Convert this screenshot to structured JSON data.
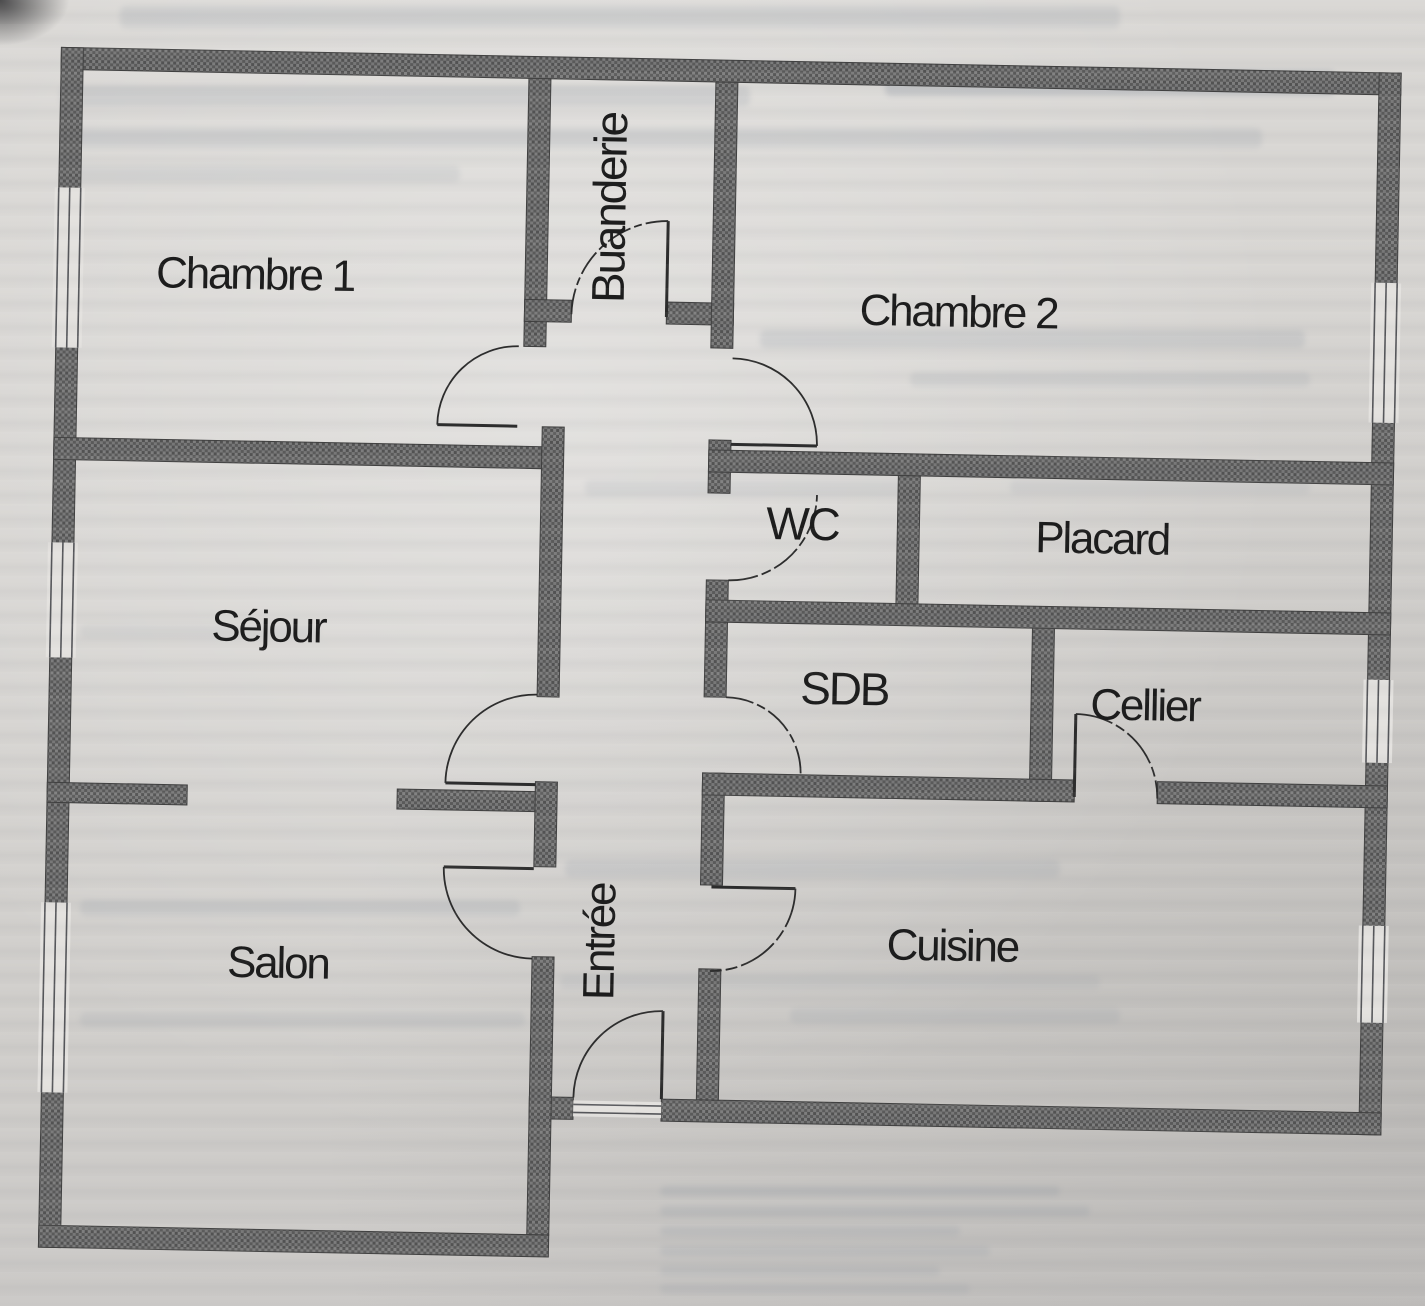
{
  "document": {
    "kind": "scanned apartment floor plan",
    "language": "French",
    "orientation": "plan occupies full page, slightly tilted scan with bleed-through text from reverse side"
  },
  "colors": {
    "paper": "#d6d4d1",
    "wall_fill": "#6d6d6d",
    "wall_speckle_dark": "#525252",
    "wall_speckle_light": "#7e7e7e",
    "wall_outline": "#3f3f3f",
    "thin_line": "#2b2b2b",
    "label_ink": "#1b1b1b",
    "bleed_text": "#8e97a2"
  },
  "rooms": {
    "chambre1": {
      "label": "Chambre 1",
      "text_orientation": "horizontal"
    },
    "buanderie": {
      "label": "Buanderie",
      "text_orientation": "vertical"
    },
    "chambre2": {
      "label": "Chambre 2",
      "text_orientation": "horizontal"
    },
    "wc": {
      "label": "WC",
      "text_orientation": "horizontal"
    },
    "placard": {
      "label": "Placard",
      "text_orientation": "horizontal"
    },
    "sejour": {
      "label": "Séjour",
      "text_orientation": "horizontal"
    },
    "sdb": {
      "label": "SDB",
      "text_orientation": "horizontal"
    },
    "cellier": {
      "label": "Cellier",
      "text_orientation": "horizontal"
    },
    "salon": {
      "label": "Salon",
      "text_orientation": "horizontal"
    },
    "entree": {
      "label": "Entrée",
      "text_orientation": "vertical"
    },
    "cuisine": {
      "label": "Cuisine",
      "text_orientation": "horizontal"
    }
  },
  "plan_features": {
    "window_count": 6,
    "door_swing_count": 10,
    "main_entrance_location": "bottom center of plan, between Salon and Cuisine",
    "windows": [
      "left wall - Chambre 1",
      "left wall - Séjour",
      "left wall - Salon",
      "right wall - Chambre 2",
      "right wall - Cellier",
      "right wall - Cuisine"
    ]
  }
}
